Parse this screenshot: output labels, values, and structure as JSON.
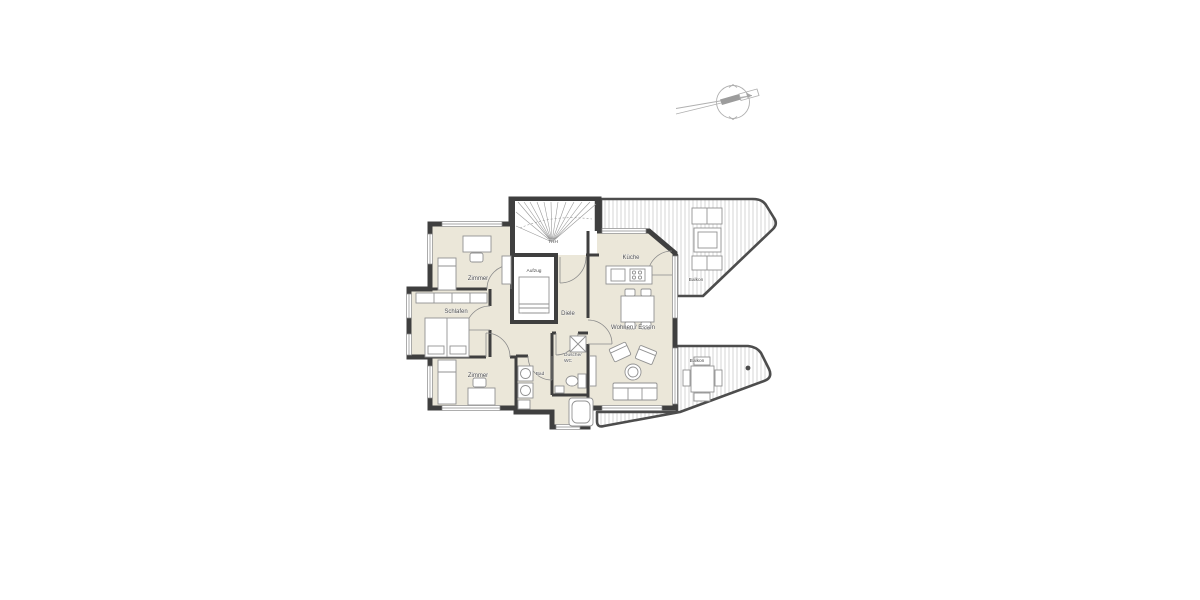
{
  "page": {
    "kind": "architectural-floor-plan",
    "background": "#ffffff"
  },
  "plan": {
    "labels": {
      "trh": "TRH",
      "aufzug": "Aufzug",
      "zimmer_top": "Zimmer",
      "schlafen": "Schlafen",
      "zimmer_bottom": "Zimmer",
      "diele": "Diele",
      "bad": "Bad",
      "dusche_line1": "Dusche/",
      "dusche_line2": "WC",
      "kueche": "Küche",
      "wohnen_essen": "Wohnen / Essen",
      "balkon_top": "Balkon",
      "balkon_bottom": "Balkon"
    },
    "colors": {
      "wall": "#3f3f3f",
      "room_fill": "#ebe7d9",
      "hatch_line": "#cccccc",
      "balcony_outline": "#4d4d4d",
      "furniture_line": "#929292",
      "label_text": "#4a4a4a",
      "compass": "#b0b0b0"
    }
  }
}
